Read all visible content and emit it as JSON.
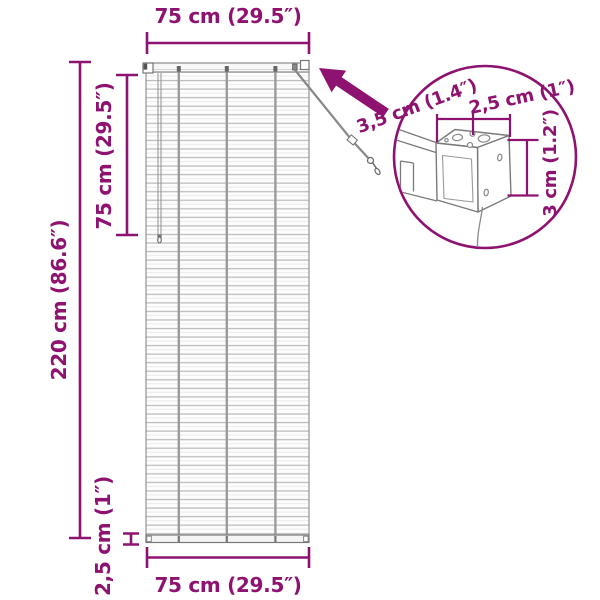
{
  "colors": {
    "accent": "#8E1270",
    "drawing": "#7a7a7a",
    "slat": "#bdbdbd"
  },
  "labels": {
    "top_width": "75 cm (29.5″)",
    "upper_height": "75 cm (29.5″)",
    "total_height": "220 cm (86.6″)",
    "bottom_rail_height": "2,5 cm (1″)",
    "bottom_width": "75 cm (29.5″)",
    "detail_depth": "3,5 cm (1.4″)",
    "detail_width": "2,5 cm (1″)",
    "detail_height": "3 cm (1.2″)"
  }
}
